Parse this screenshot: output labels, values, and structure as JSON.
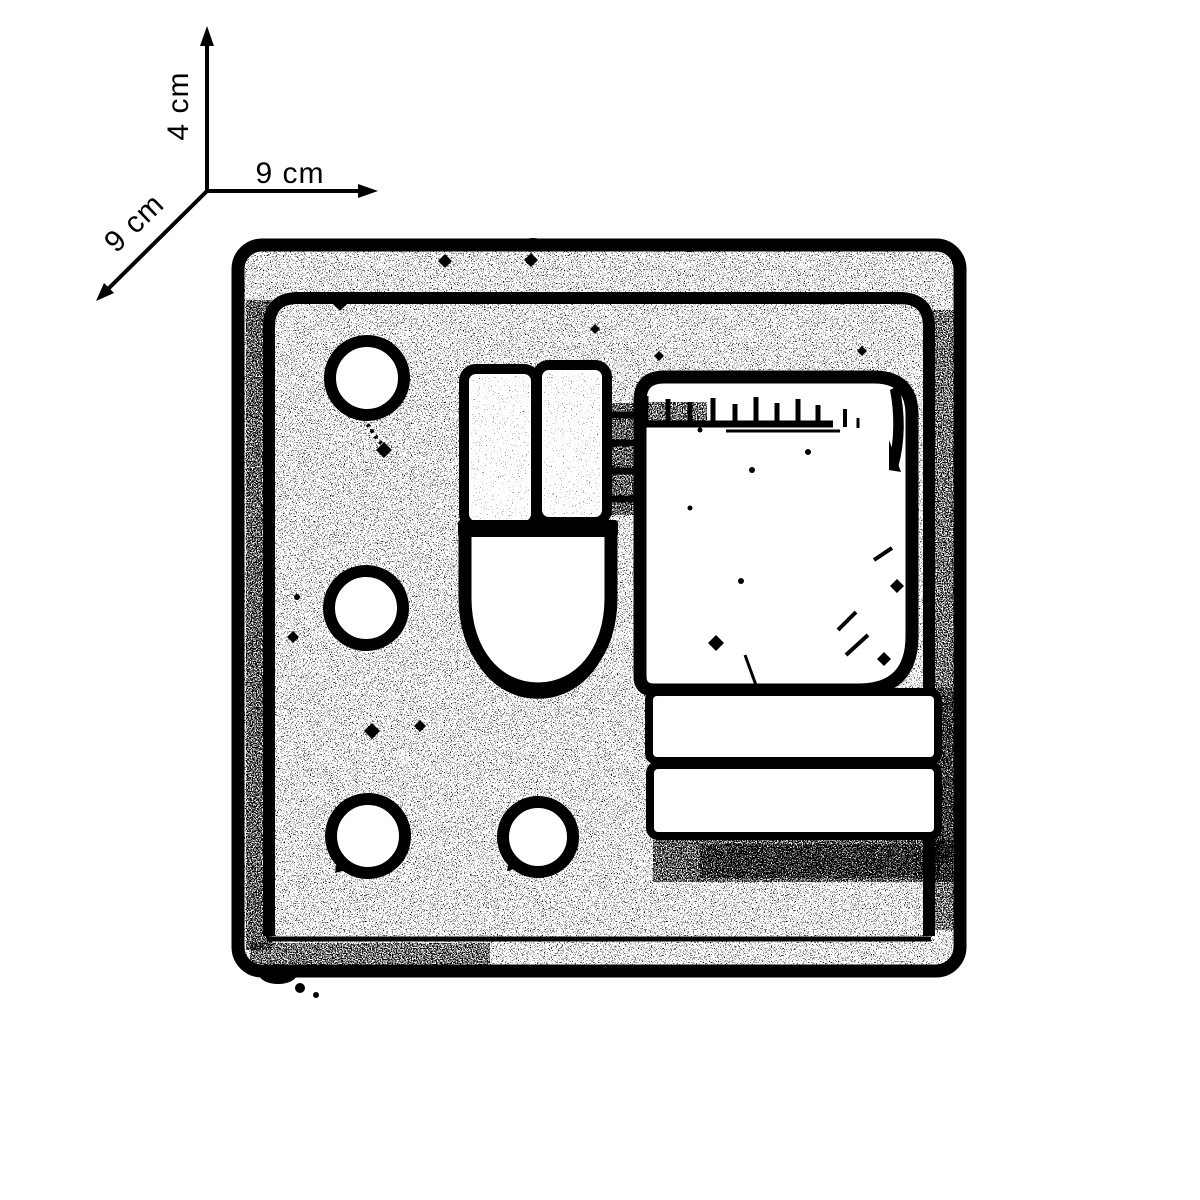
{
  "scale_indicator": {
    "height_label": "4 cm",
    "width_label": "9 cm",
    "depth_label": "9 cm"
  },
  "colors": {
    "ink": "#000000",
    "paper": "#ffffff"
  }
}
